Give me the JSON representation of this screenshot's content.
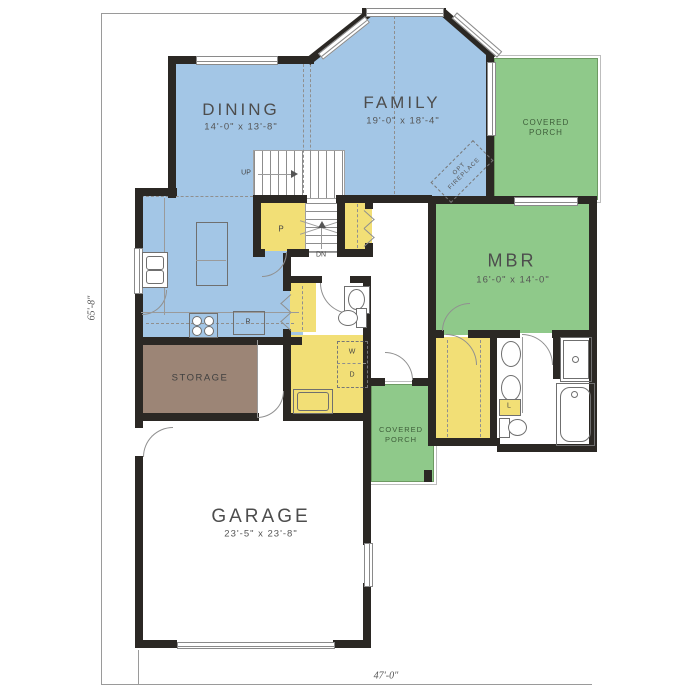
{
  "plan": {
    "type": "first-floor-plan",
    "overall": {
      "width_label": "47'-0\"",
      "height_label": "65'-8\""
    },
    "rooms": {
      "dining": {
        "name": "DINING",
        "dims": "14'-0\" x 13'-8\""
      },
      "family": {
        "name": "FAMILY",
        "dims": "19'-0\" x 18'-4\""
      },
      "mbr": {
        "name": "MBR",
        "dims": "16'-0\" x 14'-0\""
      },
      "garage": {
        "name": "GARAGE",
        "dims": "23'-5\" x 23'-8\""
      },
      "storage": {
        "name": "STORAGE"
      },
      "porch_rear": {
        "line1": "COVERED",
        "line2": "PORCH"
      },
      "porch_front": {
        "line1": "COVERED",
        "line2": "PORCH"
      }
    },
    "labels": {
      "up": "UP",
      "down": "DN",
      "pantry": "P",
      "washer": "W",
      "dryer": "D",
      "refrigerator": "R",
      "linen": "L",
      "fireplace_line1": "OPT",
      "fireplace_line2": "FIREPLACE"
    },
    "colors": {
      "living_area_blue": "#a3c6e6",
      "bedroom_porch_green": "#8fc98a",
      "closet_yellow": "#f2df76",
      "storage_brown": "#9c8576",
      "wall_black": "#2b2824",
      "line_gray": "#8f8f8f",
      "label_gray": "#4d4d4d"
    }
  }
}
